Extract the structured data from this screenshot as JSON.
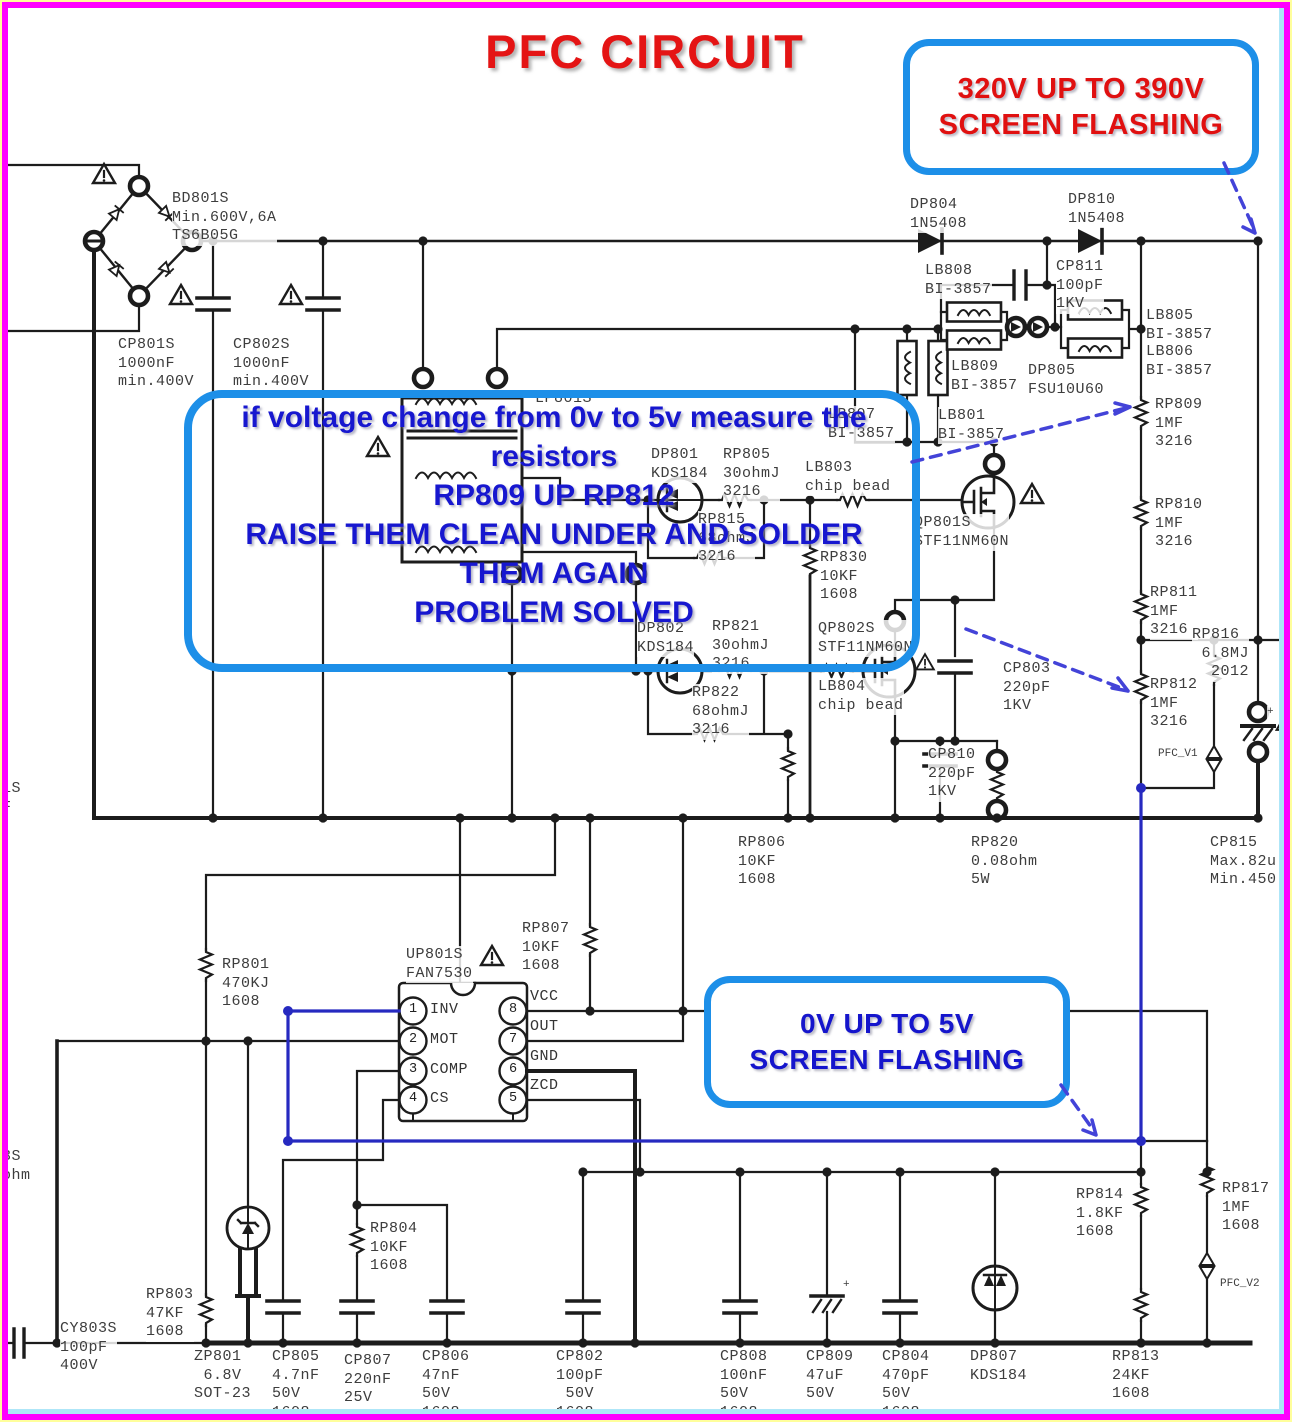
{
  "title": "PFC CIRCUIT",
  "callout_top": {
    "text": "320V UP TO 390V\nSCREEN FLASHING"
  },
  "callout_mid": {
    "text": "0V UP TO 5V\nSCREEN FLASHING"
  },
  "annotation": {
    "text": "if voltage change from 0v to 5v measure the\nresistors\nRP809 UP RP812\nRAISE THEM CLEAN UNDER AND SOLDER\nTHEM AGAIN\nPROBLEM SOLVED"
  },
  "colors": {
    "title_red": "#e41414",
    "callout_border_blue": "#1d8fe8",
    "annotation_blue": "#1717cf",
    "wire_blue": "#2629c0",
    "arrow_blue": "#4343d8",
    "frame_magenta": "#ff00ff",
    "frame_cyan": "#aee6f8",
    "frame_yellow": "#ffff9c"
  },
  "ic": {
    "name": "UP801S",
    "part": "FAN7530",
    "left_pins": [
      {
        "n": "1",
        "label": "INV"
      },
      {
        "n": "2",
        "label": "MOT"
      },
      {
        "n": "3",
        "label": "COMP"
      },
      {
        "n": "4",
        "label": "CS"
      }
    ],
    "right_pins": [
      {
        "n": "8",
        "label": "VCC"
      },
      {
        "n": "7",
        "label": "OUT"
      },
      {
        "n": "6",
        "label": "GND"
      },
      {
        "n": "5",
        "label": "ZCD"
      }
    ]
  },
  "labels": [
    {
      "text": "BD801S\nMin.600V,6A\nTS6B05G",
      "x": 172,
      "y": 190
    },
    {
      "text": "CP801S\n1000nF\nmin.400V",
      "x": 118,
      "y": 336
    },
    {
      "text": "CP802S\n1000nF\nmin.400V",
      "x": 233,
      "y": 336
    },
    {
      "text": "DP804\n1N5408",
      "x": 910,
      "y": 196
    },
    {
      "text": "DP810\n1N5408",
      "x": 1068,
      "y": 191
    },
    {
      "text": "LB808\nBI-3857",
      "x": 925,
      "y": 262
    },
    {
      "text": "CP811\n100pF\n1KV",
      "x": 1056,
      "y": 258
    },
    {
      "text": "LB805\nBI-3857",
      "x": 1146,
      "y": 307
    },
    {
      "text": "LB806\nBI-3857",
      "x": 1146,
      "y": 343
    },
    {
      "text": "LB809\nBI-3857",
      "x": 951,
      "y": 358
    },
    {
      "text": "DP805\nFSU10U60",
      "x": 1028,
      "y": 362
    },
    {
      "text": "LB801\nBI-3857",
      "x": 938,
      "y": 407
    },
    {
      "text": "LB807\nBI-3857",
      "x": 828,
      "y": 406
    },
    {
      "text": "LP801S",
      "x": 535,
      "y": 390
    },
    {
      "text": "DP801\nKDS184",
      "x": 651,
      "y": 446
    },
    {
      "text": "RP805\n30ohmJ\n3216",
      "x": 723,
      "y": 446
    },
    {
      "text": "LB803\nchip bead",
      "x": 805,
      "y": 459
    },
    {
      "text": "RP815\n68ohmJ\n3216",
      "x": 698,
      "y": 511
    },
    {
      "text": "QP801S\nSTF11NM60N",
      "x": 914,
      "y": 514
    },
    {
      "text": "RP830\n10KF\n1608",
      "x": 820,
      "y": 549
    },
    {
      "text": "RP809\n1MF\n3216",
      "x": 1155,
      "y": 396
    },
    {
      "text": "RP810\n1MF\n3216",
      "x": 1155,
      "y": 496
    },
    {
      "text": "RP811\n1MF\n3216",
      "x": 1150,
      "y": 584
    },
    {
      "text": "RP816\n 6.8MJ\n  2012",
      "x": 1192,
      "y": 626
    },
    {
      "text": "DP802\nKDS184",
      "x": 637,
      "y": 620
    },
    {
      "text": "RP821\n30ohmJ\n3216",
      "x": 712,
      "y": 618
    },
    {
      "text": "QP802S\nSTF11NM60N",
      "x": 818,
      "y": 620
    },
    {
      "text": "RP822\n68ohmJ\n3216",
      "x": 692,
      "y": 684
    },
    {
      "text": "LB804\nchip bead",
      "x": 818,
      "y": 678
    },
    {
      "text": "CP803\n220pF\n1KV",
      "x": 1003,
      "y": 660
    },
    {
      "text": "RP812\n1MF\n3216",
      "x": 1150,
      "y": 676
    },
    {
      "text": "CP810\n220pF\n1KV",
      "x": 928,
      "y": 746
    },
    {
      "text": "PFC_V1",
      "x": 1158,
      "y": 748,
      "cls": "sm"
    },
    {
      "text": "RP806\n10KF\n1608",
      "x": 738,
      "y": 834
    },
    {
      "text": "RP820\n0.08ohm\n5W",
      "x": 971,
      "y": 834
    },
    {
      "text": "CP815\nMax.82u\nMin.450",
      "x": 1210,
      "y": 834
    },
    {
      "text": "RP801\n470KJ\n1608",
      "x": 222,
      "y": 956
    },
    {
      "text": "UP801S\nFAN7530",
      "x": 406,
      "y": 946
    },
    {
      "text": "RP807\n10KF\n1608",
      "x": 522,
      "y": 920
    },
    {
      "text": "RP814\n1.8KF\n1608",
      "x": 1076,
      "y": 1186
    },
    {
      "text": "RP817\n1MF\n1608",
      "x": 1222,
      "y": 1180
    },
    {
      "text": "PFC_V2",
      "x": 1220,
      "y": 1278,
      "cls": "sm"
    },
    {
      "text": "RP804\n10KF\n1608",
      "x": 370,
      "y": 1220
    },
    {
      "text": "RP803\n47KF\n1608",
      "x": 146,
      "y": 1286
    },
    {
      "text": "CY803S\n100pF\n400V",
      "x": 60,
      "y": 1320
    },
    {
      "text": "ZP801\n 6.8V\nSOT-23",
      "x": 194,
      "y": 1348
    },
    {
      "text": "CP805\n4.7nF\n50V\n1608",
      "x": 272,
      "y": 1348
    },
    {
      "text": "CP807\n220nF\n25V\n1608",
      "x": 344,
      "y": 1352
    },
    {
      "text": "CP806\n47nF\n50V\n1608",
      "x": 422,
      "y": 1348
    },
    {
      "text": "CP802\n100pF\n 50V\n1608",
      "x": 556,
      "y": 1348
    },
    {
      "text": "CP808\n100nF\n50V\n1608",
      "x": 720,
      "y": 1348
    },
    {
      "text": "CP809\n47uF\n50V",
      "x": 806,
      "y": 1348
    },
    {
      "text": "CP804\n470pF\n50V\n1608",
      "x": 882,
      "y": 1348
    },
    {
      "text": "DP807\nKDS184",
      "x": 970,
      "y": 1348
    },
    {
      "text": "RP813\n24KF\n1608",
      "x": 1112,
      "y": 1348
    },
    {
      "text": "1S\nF",
      "x": 2,
      "y": 780
    },
    {
      "text": "3S\nohm",
      "x": 2,
      "y": 1148
    },
    {
      "text": "+",
      "x": 843,
      "y": 1279,
      "cls": "sm"
    },
    {
      "text": "+",
      "x": 1267,
      "y": 706,
      "cls": "sm"
    }
  ]
}
